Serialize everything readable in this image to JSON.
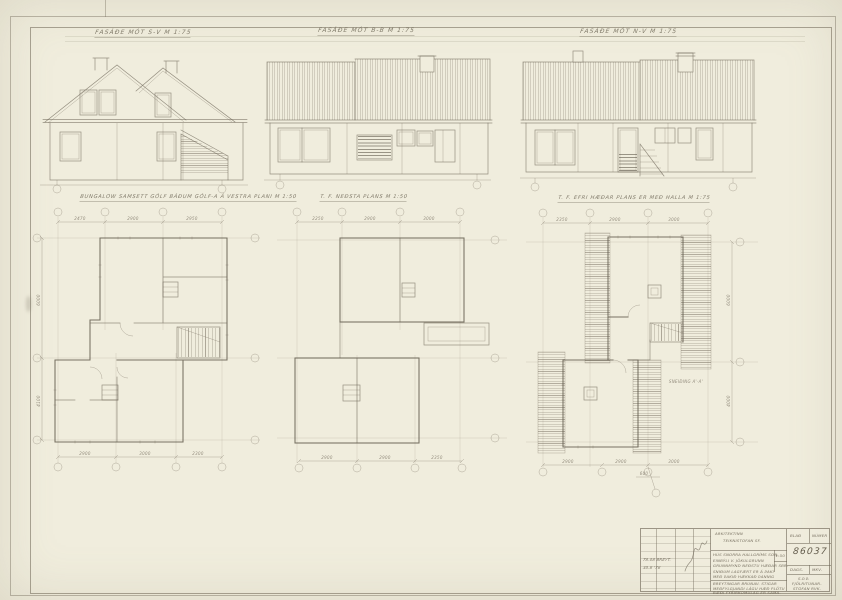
{
  "sheet": {
    "paper_color": "#f0eddd",
    "pencil_color": "#867f70"
  },
  "elevations": [
    {
      "title": "FASÁÐE MÓT S-V M 1:75"
    },
    {
      "title": "FASÁÐE MÓT B-B M 1:75"
    },
    {
      "title": "FASÁÐE MÓT N-V M 1:75"
    }
  ],
  "plans": [
    {
      "title": "BUNGALOW SAMSETT GÓLF BÁÐUM GÓLF-A Á VESTRA PLANI M 1:50",
      "dims_top": [
        "2470",
        "2900",
        "2950"
      ],
      "dims_bottom": [
        "2900",
        "3000",
        "2300"
      ],
      "dims_left": [
        "6000",
        "4100"
      ]
    },
    {
      "title": "T. F. NEÐSTA PLANS M 1:50",
      "dims_top": [
        "2250",
        "2900",
        "3000"
      ],
      "dims_bottom": [
        "2900",
        "2900",
        "2350"
      ]
    },
    {
      "title": "T. F. EFRI HÆÐAR PLANS ER MEÐ HALLA M 1:75",
      "dims_top": [
        "2350",
        "2900",
        "3000"
      ],
      "dims_bottom": [
        "2900",
        "2900",
        "3000"
      ],
      "dims_right": [
        "6000",
        "4000"
      ],
      "extra_dim": "600",
      "annotation": "SNEIÐING A'-A'"
    }
  ],
  "title_block": {
    "header_line1": "ARKITEKTINN",
    "header_line2": "TEIKNISTOFAN SF.",
    "desc_lines": [
      "HÚS SNORRA HALLGRÍMS SON.",
      "EINBÝLI V. JÖKULGRUNN",
      "GRUNNMYND NEÐSTU HÆÐAR SBR.",
      "SNIÐUM LAGFÆRT ER Á ÞAKI",
      "MEÐ ÞAKIÐ HÆKKAÐ ÞANNIG"
    ],
    "bottom_lines": [
      "BREYTINGAR BRUNAV. STIGAR",
      "MEÐFYLGJANDI LÁGU HÆÐ PLÖTU",
      "BÆÐI FYRIRKOMULAG ER SAMA."
    ],
    "number_label_1": "BLAÐ",
    "number_label_2": "NÚMER",
    "number": "86037",
    "scale": "1:50",
    "date_label": "DAGS.",
    "size_label": "MKV.",
    "footer_lines": [
      "S.Þ.Þ.",
      "FJÖLRITUNAR-",
      "STOFAN RVK."
    ],
    "rev_entries": [
      "78.08  BREYT.",
      "30.8  '78"
    ]
  }
}
